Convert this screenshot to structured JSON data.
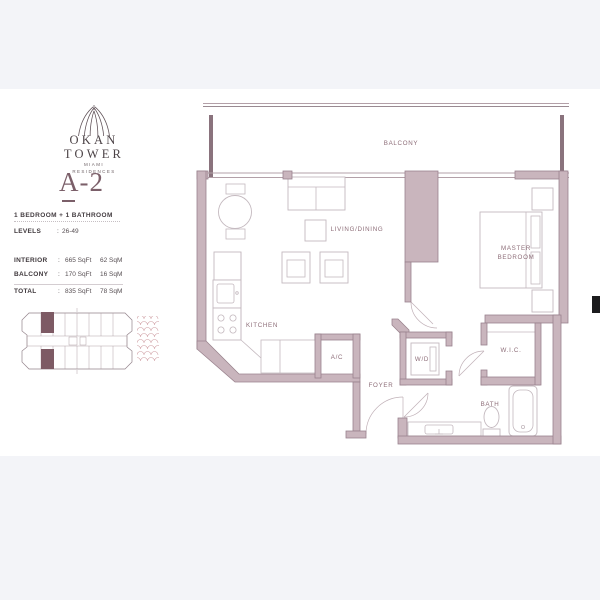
{
  "branding": {
    "name_line1": "OKAN",
    "name_line2": "TOWER",
    "tagline_line1": "MIAMI",
    "tagline_line2": "RESIDENCES"
  },
  "unit": {
    "code": "A-2",
    "type_line": "1 BEDROOM + 1 BATHROOM",
    "levels_label": "LEVELS",
    "colon": ":",
    "levels_value": "26-49",
    "areas": [
      {
        "label": "INTERIOR",
        "sqft": "665 SqFt",
        "sqm": "62 SqM"
      },
      {
        "label": "BALCONY",
        "sqft": "170 SqFt",
        "sqm": "16 SqM"
      },
      {
        "label": "TOTAL",
        "sqft": "835 SqFt",
        "sqm": "78 SqM"
      }
    ]
  },
  "floorplan": {
    "rooms": {
      "balcony": "BALCONY",
      "living_dining": "LIVING/DINING",
      "master_line1": "MASTER",
      "master_line2": "BEDROOM",
      "kitchen": "KITCHEN",
      "ac": "A/C",
      "foyer": "FOYER",
      "wd": "W/D",
      "wic": "W.I.C.",
      "bath": "BATH"
    }
  },
  "colors": {
    "background": "#f3f4f8",
    "panel": "#ffffff",
    "wall_fill": "#c9b5bd",
    "wall_outline": "#9a838e",
    "room_label": "#8d6d78",
    "accent": "#7b5f69",
    "keyplan_unit": "#7d5a64",
    "water_pattern": "#cf9fa4"
  }
}
